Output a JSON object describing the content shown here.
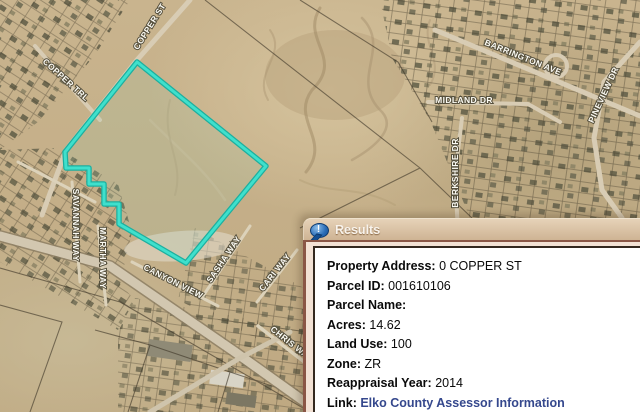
{
  "map": {
    "street_labels": [
      {
        "id": "copper-st",
        "text": "COPPER ST"
      },
      {
        "id": "copper-trl",
        "text": "COPPER TRL"
      },
      {
        "id": "barrington-ave",
        "text": "BARRINGTON AVE"
      },
      {
        "id": "midland-dr",
        "text": "MIDLAND DR"
      },
      {
        "id": "berkshire-dr",
        "text": "BERKSHIRE DR"
      },
      {
        "id": "pineview-dr",
        "text": "PINEVIEW DR"
      },
      {
        "id": "savannah-way",
        "text": "SAVANNAH WAY"
      },
      {
        "id": "martha-way",
        "text": "MARTHA WAY"
      },
      {
        "id": "canyon-view",
        "text": "CANYON VIEW"
      },
      {
        "id": "sasha-way",
        "text": "SASHA WAY"
      },
      {
        "id": "cari-way",
        "text": "CARI WAY"
      },
      {
        "id": "chris-way",
        "text": "CHRIS WAY"
      }
    ],
    "selected_parcel": {
      "outline_color": "#3fe0cc",
      "outline_dark": "#1daf9f",
      "points": "137,62 266,166 186,263 119,224 119,204 104,204 104,184 89,184 89,168 66,168 65,152"
    }
  },
  "results_panel": {
    "title": "Results",
    "icon": "speech-bubble-exclamation-icon",
    "icon_mark": "!",
    "fields": [
      {
        "label": "Property Address:",
        "value": "0 COPPER ST"
      },
      {
        "label": "Parcel ID:",
        "value": "001610106"
      },
      {
        "label": "Parcel Name:",
        "value": ""
      },
      {
        "label": "Acres:",
        "value": "14.62"
      },
      {
        "label": "Land Use:",
        "value": "100"
      },
      {
        "label": "Zone:",
        "value": "ZR"
      },
      {
        "label": "Reappraisal Year:",
        "value": "2014"
      }
    ],
    "link_row": {
      "label": "Link:",
      "value": "Elko County Assessor Information",
      "color": "#35488d"
    }
  }
}
